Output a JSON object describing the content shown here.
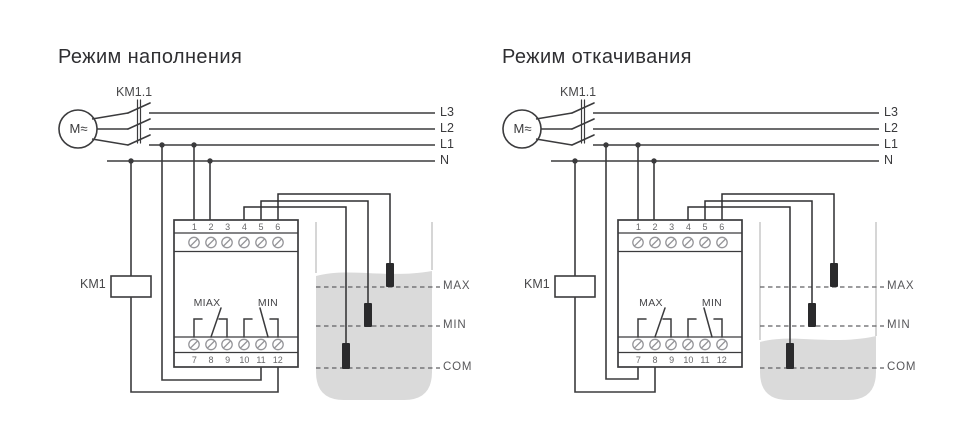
{
  "colors": {
    "wire": "#3b3b3d",
    "screw_outline": "#96969a",
    "water_fill": "#dadada",
    "tank_wall": "#c9c9c9",
    "level_dash": "#616163",
    "electrode": "#2a2a2c",
    "title_text": "#2f2f32",
    "secondary_text": "#68686a"
  },
  "diagrams": [
    {
      "title": "Режим наполнения",
      "motor_label": "M≈",
      "contactor_label": "KM1.1",
      "coil_label": "KM1",
      "line_labels": [
        "L3",
        "L2",
        "L1",
        "N"
      ],
      "relay": {
        "top_terminals": [
          "1",
          "2",
          "3",
          "4",
          "5",
          "6"
        ],
        "bottom_terminals": [
          "7",
          "8",
          "9",
          "10",
          "11",
          "12"
        ],
        "max_contact_label": "MIAX",
        "min_contact_label": "MIN"
      },
      "tank": {
        "level_labels": [
          "MAX",
          "MIN",
          "COM"
        ],
        "water_level": "above MAX (tank full)"
      }
    },
    {
      "title": "Режим откачивания",
      "motor_label": "M≈",
      "contactor_label": "KM1.1",
      "coil_label": "KM1",
      "line_labels": [
        "L3",
        "L2",
        "L1",
        "N"
      ],
      "relay": {
        "top_terminals": [
          "1",
          "2",
          "3",
          "4",
          "5",
          "6"
        ],
        "bottom_terminals": [
          "7",
          "8",
          "9",
          "10",
          "11",
          "12"
        ],
        "max_contact_label": "MAX",
        "min_contact_label": "MIN"
      },
      "tank": {
        "level_labels": [
          "MAX",
          "MIN",
          "COM"
        ],
        "water_level": "below MIN (tank low)"
      }
    }
  ]
}
